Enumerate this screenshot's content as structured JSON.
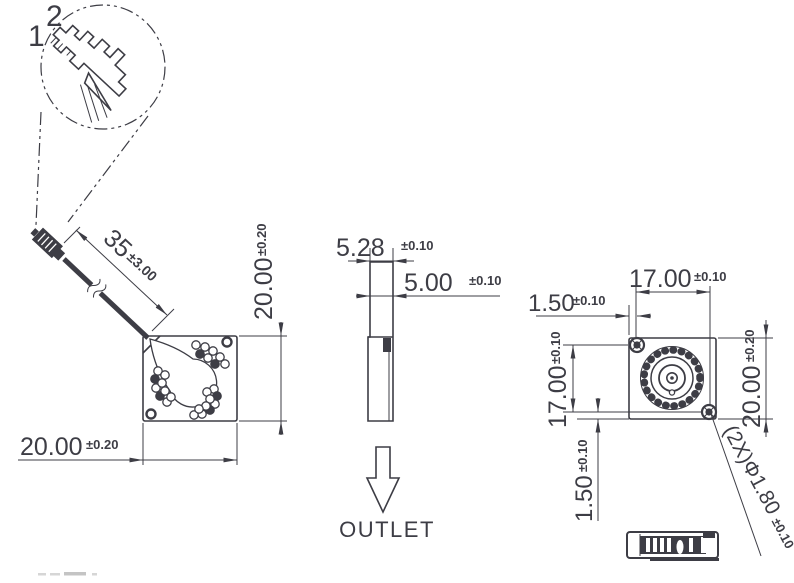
{
  "colors": {
    "line": "#3d3d45",
    "background": "#ffffff"
  },
  "detail_view": {
    "callout_1": "1",
    "callout_2": "2"
  },
  "labels": {
    "outlet": "OUTLET"
  },
  "dims": {
    "wire_length": {
      "v": "35",
      "t": "±3.00"
    },
    "tv_height": {
      "v": "20.00",
      "t": "±0.20"
    },
    "tv_width": {
      "v": "20.00",
      "t": "±0.20"
    },
    "sv_top_thickness": {
      "v": "5.28",
      "t": "±0.10"
    },
    "sv_body_thickness": {
      "v": "5.00",
      "t": "±0.10"
    },
    "fv_hole_pitch_top": {
      "v": "17.00",
      "t": "±0.10"
    },
    "fv_hole_offset_left": {
      "v": "1.50",
      "t": "±0.10"
    },
    "fv_hole_pitch_left": {
      "v": "17.00",
      "t": "±0.10"
    },
    "fv_body_height": {
      "v": "20.00",
      "t": "±0.20"
    },
    "fv_hole_offset_bottom": {
      "v": "1.50",
      "t": "±0.10"
    },
    "fv_mounting_holes": {
      "v": "(2X)Φ1.80",
      "t": "±0.10"
    }
  }
}
